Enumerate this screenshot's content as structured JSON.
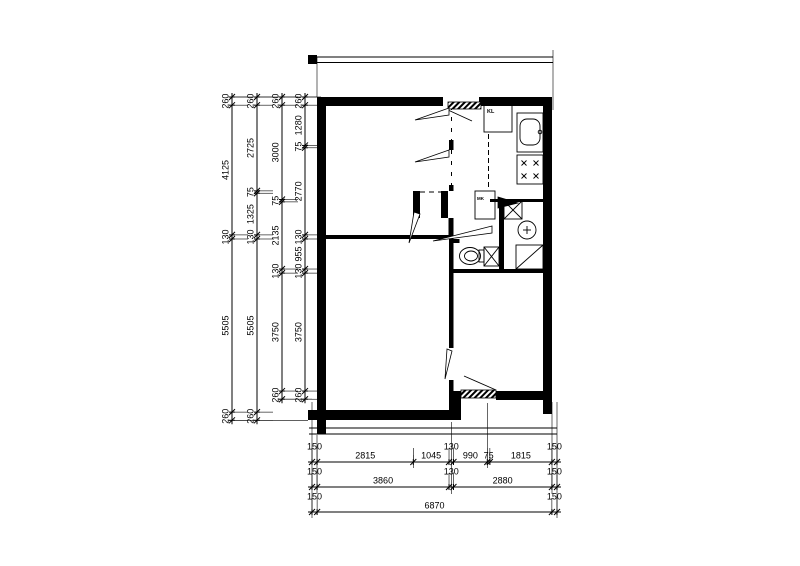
{
  "plan": {
    "labels": {
      "closet": "KL",
      "meter_cupboard": "MK"
    },
    "colors": {
      "line": "#000000",
      "wall": "#000000",
      "background": "#ffffff"
    }
  },
  "dimensions": {
    "unit_note": "",
    "left_columns": [
      {
        "values": [
          260,
          4125,
          130,
          5505,
          260
        ]
      },
      {
        "values": [
          260,
          2725,
          75,
          1325,
          130,
          5505,
          260
        ]
      },
      {
        "values": [
          260,
          3000,
          75,
          2135,
          130,
          3750,
          260
        ]
      },
      {
        "values": [
          260,
          1280,
          75,
          2770,
          130,
          955,
          130,
          3750,
          260
        ]
      }
    ],
    "bottom_rows": [
      {
        "values": [
          150,
          2815,
          1045,
          130,
          990,
          75,
          1815,
          150
        ]
      },
      {
        "values": [
          150,
          3860,
          130,
          2880,
          150
        ]
      },
      {
        "values": [
          150,
          6870,
          150
        ]
      }
    ]
  }
}
